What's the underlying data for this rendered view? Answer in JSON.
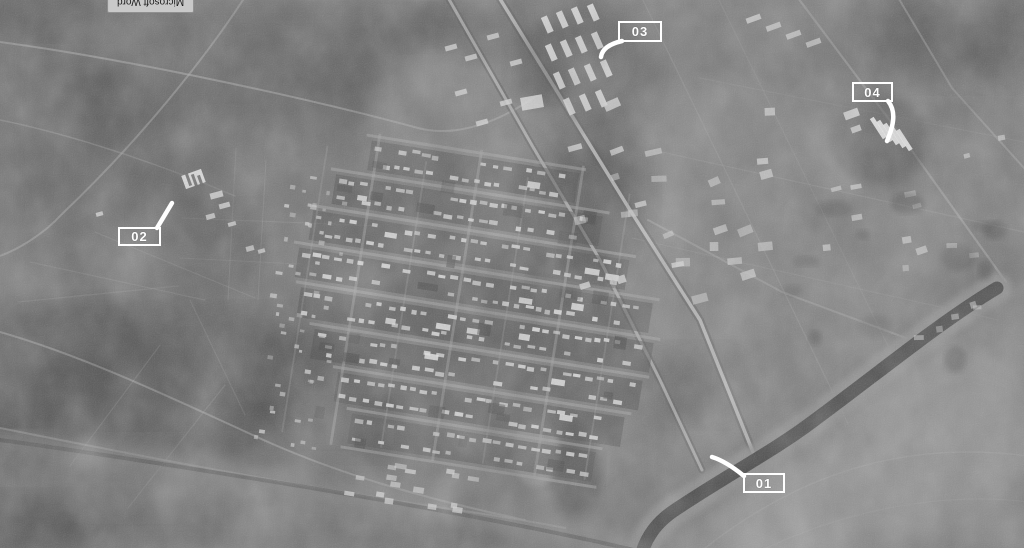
{
  "screen": {
    "tooltip": {
      "text": "Microsoft Word"
    }
  },
  "annotations": {
    "color": "#ffffff",
    "labels": [
      {
        "id": "01",
        "text": "01",
        "box": {
          "x": 743,
          "y": 473,
          "w": 42,
          "h": 20
        },
        "leader": "M744,476 C733,467 722,460 712,457"
      },
      {
        "id": "02",
        "text": "02",
        "box": {
          "x": 118,
          "y": 227,
          "w": 43,
          "h": 19
        },
        "leader": "M157,228 L172,203"
      },
      {
        "id": "03",
        "text": "03",
        "box": {
          "x": 618,
          "y": 21,
          "w": 44,
          "h": 21
        },
        "leader": "M622,41 C609,44 602,49 601,57"
      },
      {
        "id": "04",
        "text": "04",
        "box": {
          "x": 852,
          "y": 82,
          "w": 41,
          "h": 20
        },
        "leader": "M888,101 C897,112 893,127 887,141"
      }
    ]
  }
}
